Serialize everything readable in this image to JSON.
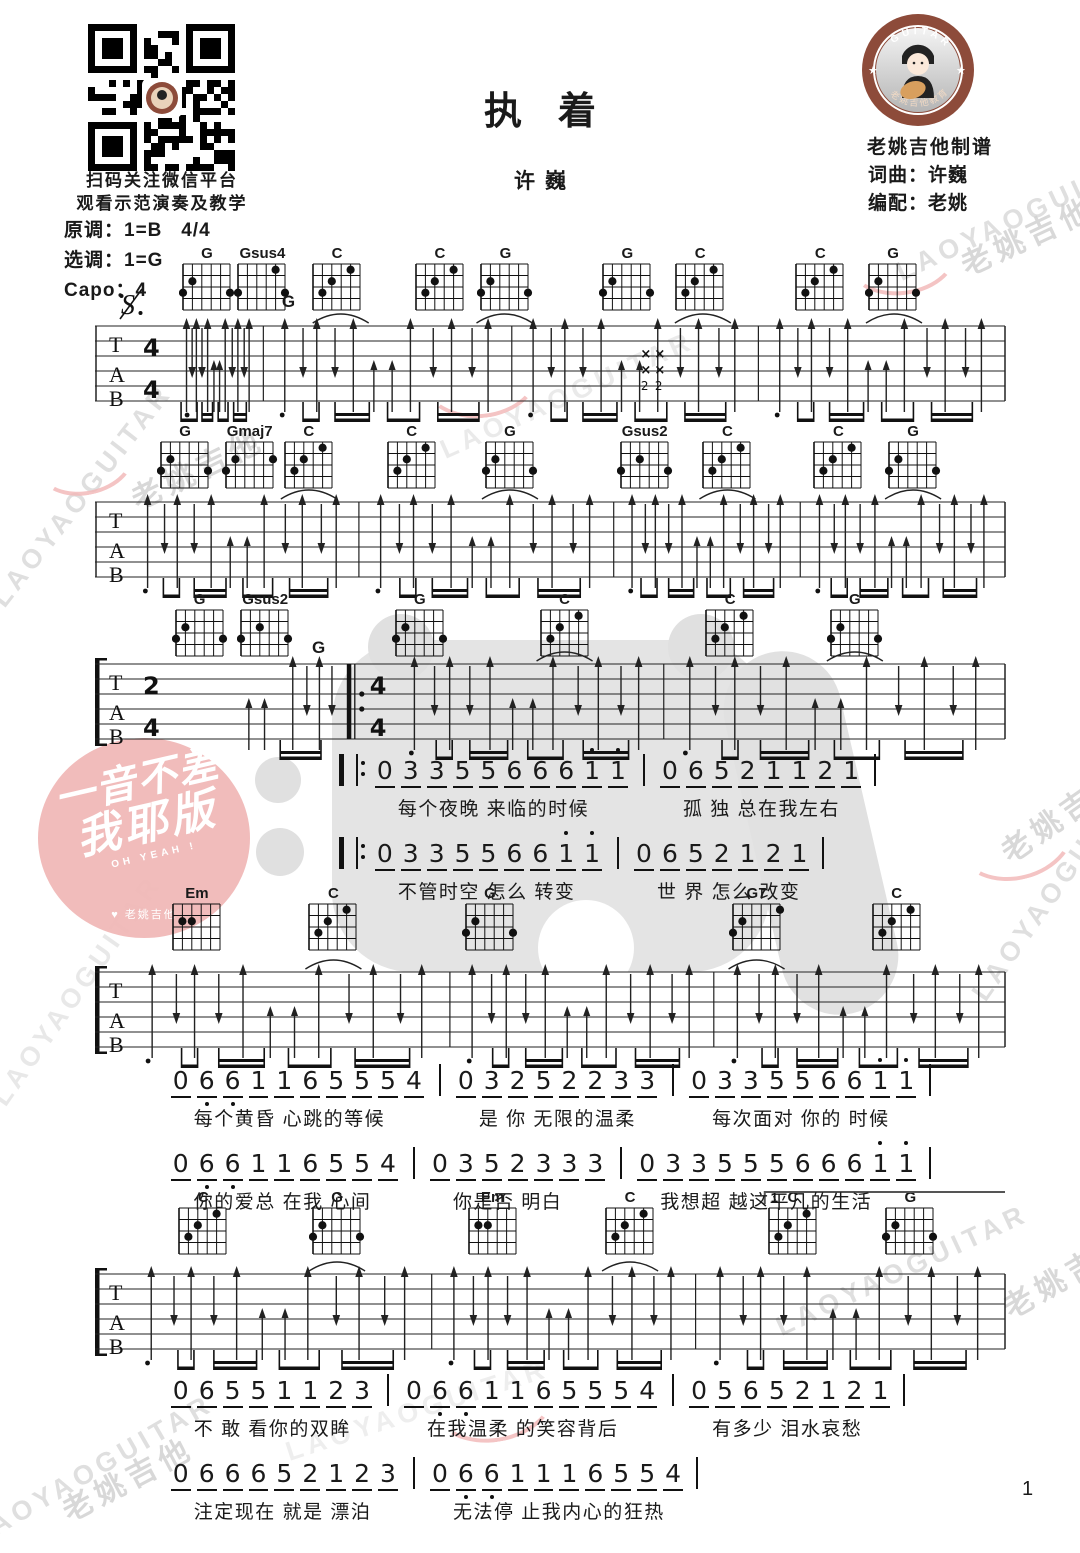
{
  "header": {
    "qr_caption_1": "扫码关注微信平台",
    "qr_caption_2": "观看示范演奏及教学",
    "title": "执着",
    "artist": "许巍",
    "logo_ring_text": "GUITAR",
    "logo_bottom_text": "老姚吉他教育",
    "studio": "老姚吉他制谱",
    "credit_lyrics": "词曲：许巍",
    "credit_arrange": "编配：老姚"
  },
  "key_info": {
    "original_key": "原调：1=B",
    "time_signature": "4/4",
    "play_key": "选调：1=G",
    "capo": "Capo：4"
  },
  "watermark": {
    "text_en": "LAOYAOGUITAR",
    "text_cn": "老姚吉他"
  },
  "stamp": {
    "line1": "一音不差",
    "line2": "我耶版",
    "sub": "OH YEAH !",
    "brand": "♥ 老姚吉他"
  },
  "page": {
    "number": "1"
  },
  "colors": {
    "logo_brown": "#8d4b3a",
    "stamp_pink": "#f0b8b7",
    "watermark_gray": "#dadada",
    "ink": "#1a1a1a"
  },
  "chord_shapes": {
    "G": [
      [
        0,
        3
      ],
      [
        1,
        2
      ],
      [
        5,
        3
      ]
    ],
    "Gsus4": [
      [
        0,
        3
      ],
      [
        4,
        1
      ],
      [
        5,
        3
      ]
    ],
    "C": [
      [
        1,
        3
      ],
      [
        2,
        2
      ],
      [
        4,
        1
      ]
    ],
    "Gmaj7": [
      [
        0,
        3
      ],
      [
        1,
        2
      ],
      [
        5,
        2
      ]
    ],
    "Gsus2": [
      [
        0,
        3
      ],
      [
        2,
        2
      ],
      [
        5,
        3
      ]
    ],
    "Em": [
      [
        1,
        2
      ],
      [
        2,
        2
      ]
    ],
    "G7": [
      [
        0,
        3
      ],
      [
        1,
        2
      ],
      [
        5,
        1
      ]
    ]
  },
  "systems": [
    {
      "name": "intro-1",
      "top": 246,
      "staff_top": 314,
      "time": [
        "4",
        "4"
      ],
      "bracket": false,
      "bounds": [
        0,
        0.185,
        0.458,
        0.729,
        1
      ],
      "chords": [
        {
          "name": "G",
          "x": 0.123
        },
        {
          "name": "Gsus4",
          "x": 0.184
        },
        {
          "name": "C",
          "x": 0.266
        },
        {
          "name": "C",
          "x": 0.379
        },
        {
          "name": "G",
          "x": 0.451
        },
        {
          "name": "G",
          "x": 0.585
        },
        {
          "name": "C",
          "x": 0.665
        },
        {
          "name": "C",
          "x": 0.797
        },
        {
          "name": "G",
          "x": 0.877
        }
      ],
      "labels": [
        {
          "text": "G",
          "x": 0.212
        }
      ],
      "xmarks": 0.612,
      "xmark_fret_numbers": "2 2",
      "arcs": [
        0.27,
        0.45,
        0.668,
        0.878
      ]
    },
    {
      "name": "intro-2",
      "top": 424,
      "staff_top": 490,
      "time": null,
      "bracket": false,
      "bounds": [
        0,
        0.29,
        0.57,
        0.775,
        1
      ],
      "chords": [
        {
          "name": "G",
          "x": 0.099
        },
        {
          "name": "Gmaj7",
          "x": 0.17
        },
        {
          "name": "C",
          "x": 0.235
        },
        {
          "name": "C",
          "x": 0.348
        },
        {
          "name": "G",
          "x": 0.456
        },
        {
          "name": "Gsus2",
          "x": 0.604
        },
        {
          "name": "C",
          "x": 0.695
        },
        {
          "name": "C",
          "x": 0.817
        },
        {
          "name": "G",
          "x": 0.899
        }
      ],
      "labels": [],
      "arcs": [
        0.235,
        0.456,
        0.695,
        0.899
      ]
    },
    {
      "name": "verse-pickup",
      "top": 592,
      "staff_top": 652,
      "time": [
        "2",
        "4"
      ],
      "bracket": true,
      "pickup": true,
      "repeat_at": 0.28,
      "time2": [
        "4",
        "4"
      ],
      "bounds": [
        0,
        0.28,
        0.625,
        1
      ],
      "chords": [
        {
          "name": "G",
          "x": 0.115
        },
        {
          "name": "Gsus2",
          "x": 0.187
        },
        {
          "name": "G",
          "x": 0.357
        },
        {
          "name": "C",
          "x": 0.516
        },
        {
          "name": "C",
          "x": 0.698
        },
        {
          "name": "G",
          "x": 0.835
        }
      ],
      "labels": [
        {
          "text": "G",
          "x": 0.245
        }
      ],
      "arcs": [
        0.516,
        0.835
      ]
    },
    {
      "name": "verse-a",
      "top": 886,
      "staff_top": 960,
      "time": null,
      "bracket": true,
      "bounds": [
        0,
        0.39,
        0.68,
        1
      ],
      "chords": [
        {
          "name": "Em",
          "x": 0.112
        },
        {
          "name": "C",
          "x": 0.262
        },
        {
          "name": "G",
          "x": 0.434
        },
        {
          "name": "G7",
          "x": 0.727
        },
        {
          "name": "C",
          "x": 0.881
        }
      ],
      "labels": [],
      "arcs": [
        0.262,
        0.727
      ]
    },
    {
      "name": "verse-b",
      "top": 1190,
      "staff_top": 1262,
      "time": null,
      "bracket": true,
      "bounds": [
        0,
        0.37,
        0.66,
        1
      ],
      "chords": [
        {
          "name": "C",
          "x": 0.119
        },
        {
          "name": "G",
          "x": 0.266
        },
        {
          "name": "Em",
          "x": 0.437
        },
        {
          "name": "C",
          "x": 0.588
        },
        {
          "name": "C",
          "x": 0.767
        },
        {
          "name": "G",
          "x": 0.896
        }
      ],
      "labels": [],
      "arcs": [
        0.266,
        0.588
      ],
      "volta": {
        "label": "1",
        "from": 0.736
      }
    }
  ],
  "verses": [
    {
      "top": 752,
      "left_frac": 0.268,
      "lines": [
        {
          "repeat": true,
          "measures": [
            {
              "notes": "0 3 3 5 5 6 6 6 1' 1'",
              "lyric": "每个夜晚 来临的时候"
            },
            {
              "notes": "0 6 5 2 1 1 2 1",
              "lyric": "孤 独 总在我左右"
            }
          ]
        },
        {
          "repeat": true,
          "measures": [
            {
              "notes": "0 3 3 5 5 6 6 1' 1'",
              "lyric": "不管时空 怎么 转变"
            },
            {
              "notes": "0 6 5 2 1 2 1",
              "lyric": "世 界 怎么 改变"
            }
          ]
        }
      ]
    },
    {
      "top": 1062,
      "left_frac": 0.08,
      "lines": [
        {
          "repeat": false,
          "measures": [
            {
              "notes": "0 6, 6, 1 1 6 5 5 5 4",
              "lyric": "每个黄昏 心跳的等候"
            },
            {
              "notes": "0 3 2 5 2 2 3 3",
              "lyric": "是 你 无限的温柔"
            },
            {
              "notes": "0 3 3 5 5 6 6 1' 1'",
              "lyric": "每次面对 你的 时候"
            }
          ]
        },
        {
          "repeat": false,
          "measures": [
            {
              "notes": "0 6, 6, 1 1 6 5 5 4",
              "lyric": "你的爱总 在我 心间"
            },
            {
              "notes": "0 3 5 2 3 3 3",
              "lyric": "你是否 明白"
            },
            {
              "notes": "0 3 3 5 5 5 6 6 6 1' 1'",
              "lyric": "我想超 越这平凡的生活"
            }
          ]
        }
      ]
    },
    {
      "top": 1372,
      "left_frac": 0.08,
      "lines": [
        {
          "repeat": false,
          "measures": [
            {
              "notes": "0 6 5 5 1 1 2 3",
              "lyric": "不 敢 看你的双眸"
            },
            {
              "notes": "0 6, 6, 1 1 6 5 5 5 4",
              "lyric": "在我温柔 的笑容背后"
            },
            {
              "notes": "0 5 6 5 2 1 2 1",
              "lyric": "有多少 泪水哀愁"
            }
          ]
        },
        {
          "repeat": false,
          "measures": [
            {
              "notes": "0 6 6 6 5 2 1 2 3",
              "lyric": "注定现在 就是 漂泊"
            },
            {
              "notes": "0 6, 6, 1 1 1 6 5 5 4",
              "lyric": "无法停 止我内心的狂热"
            }
          ]
        }
      ]
    }
  ]
}
